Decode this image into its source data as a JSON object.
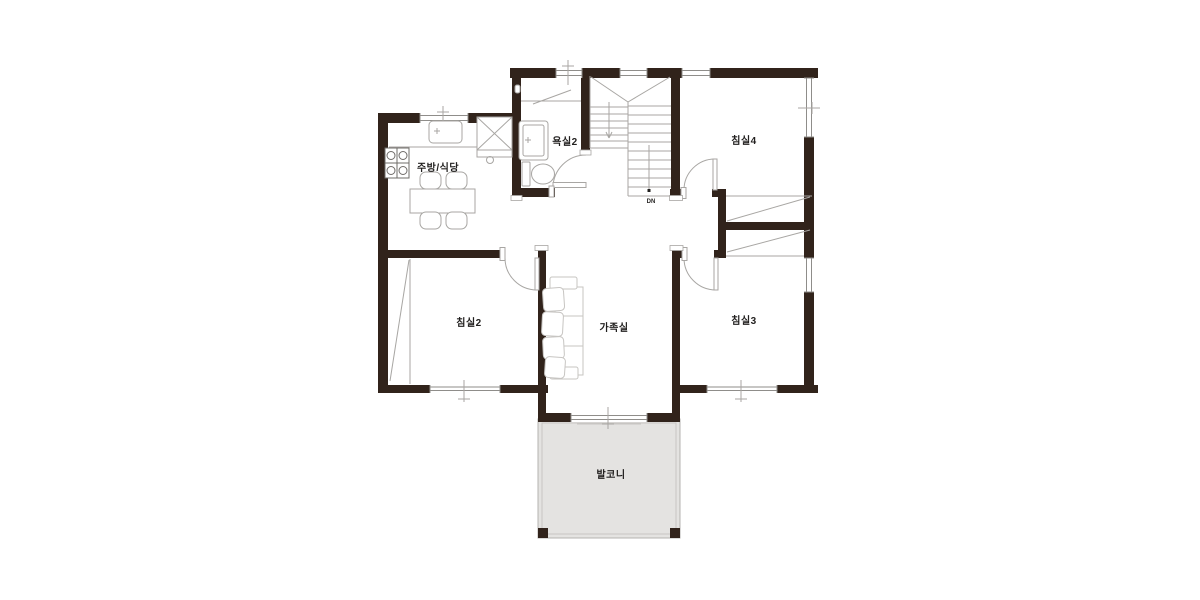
{
  "plan": {
    "rooms": [
      {
        "id": "kitchen-dining",
        "label": "주방/식당"
      },
      {
        "id": "bathroom-2",
        "label": "욕실2"
      },
      {
        "id": "bedroom-4",
        "label": "침실4"
      },
      {
        "id": "bedroom-2",
        "label": "침실2"
      },
      {
        "id": "family-room",
        "label": "가족실"
      },
      {
        "id": "bedroom-3",
        "label": "침실3"
      },
      {
        "id": "balcony",
        "label": "발코니"
      }
    ],
    "stairs_label": "DN"
  },
  "colors": {
    "wall": "#31231b",
    "line": "#a8a6a3",
    "line_soft": "#c7c5c2",
    "glass": "#8f8d8a",
    "balcony_fill": "#e4e3e1",
    "text": "#211f1e",
    "background": "#ffffff"
  }
}
